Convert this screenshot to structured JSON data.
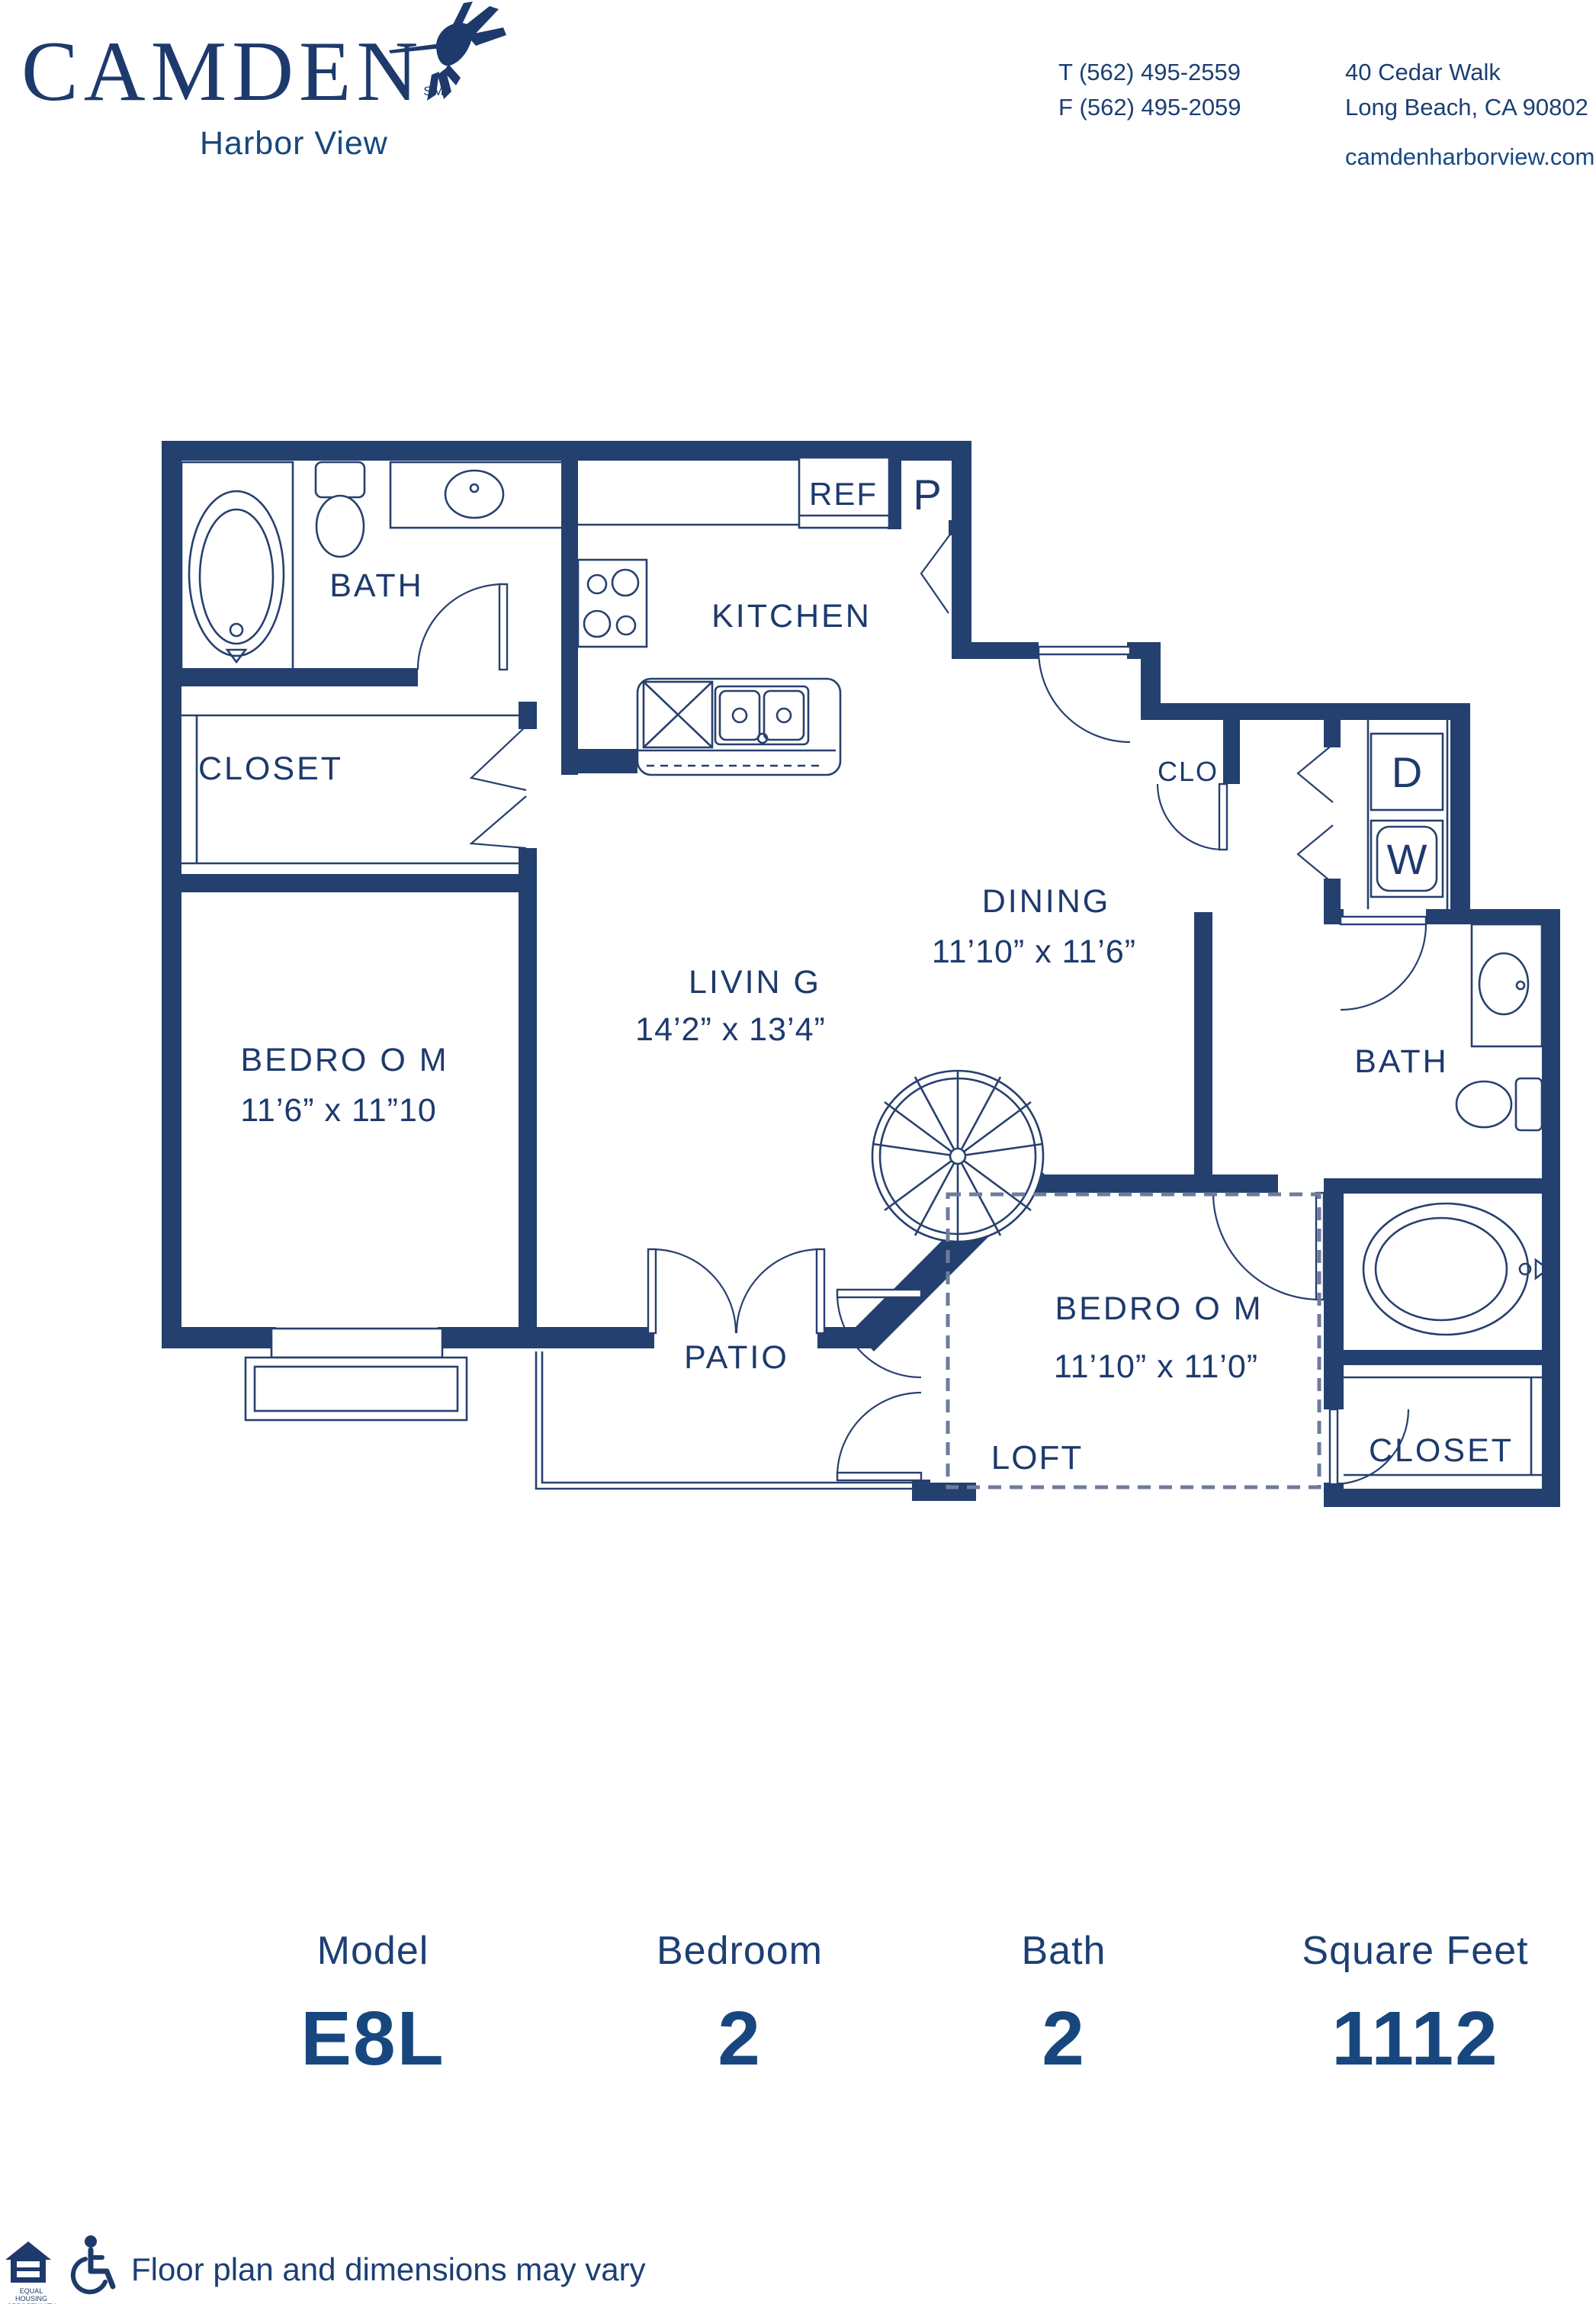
{
  "brand": {
    "logo_text": "CAMDEN",
    "logo_sm": "SM",
    "tagline": "Harbor View"
  },
  "contact": {
    "phone_t": "T (562) 495-2559",
    "phone_f": "F (562) 495-2059",
    "address_line1": "40 Cedar Walk",
    "address_line2": "Long Beach, CA 90802",
    "website": "camdenharborview.com"
  },
  "plan": {
    "rooms": {
      "bath1": {
        "label": "BATH"
      },
      "closet1": {
        "label": "CLOSET"
      },
      "bedroom1": {
        "label": "BEDRO O M",
        "dims": "11’6” x 11”10"
      },
      "kitchen": {
        "label": "KITCHEN"
      },
      "living": {
        "label": "LIVIN G",
        "dims": "14’2” x 13’4”"
      },
      "dining": {
        "label": "DINING",
        "dims": "11’10” x 11’6”"
      },
      "bedroom2": {
        "label": "BEDRO O M",
        "dims": "11’10” x 11’0”"
      },
      "bath2": {
        "label": "BATH"
      },
      "closet2": {
        "label": "CLOSET"
      },
      "clo": {
        "label": "CLO"
      },
      "patio": {
        "label": "PATIO"
      },
      "loft": {
        "label": "LOFT"
      }
    },
    "fixtures": {
      "refrigerator": "REF",
      "pantry": "P",
      "dryer": "D",
      "washer": "W"
    }
  },
  "stats": {
    "columns": [
      {
        "label": "Model",
        "value": "E8L"
      },
      {
        "label": "Bedroom",
        "value": "2"
      },
      {
        "label": "Bath",
        "value": "2"
      },
      {
        "label": "Square Feet",
        "value": "1112"
      }
    ]
  },
  "footer": {
    "disclaimer": "Floor plan and dimensions may vary",
    "eho_line1": "EQUAL HOUSING",
    "eho_line2": "OPPORTUNITY"
  },
  "icons": {
    "logo": "hummingbird-icon",
    "equal_housing": "equal-housing-icon",
    "accessible": "wheelchair-icon"
  },
  "colors": {
    "navy": "#1e3a6d",
    "wall": "#23406f",
    "link_blue": "#164a84",
    "loft_muted": "#56678e"
  }
}
